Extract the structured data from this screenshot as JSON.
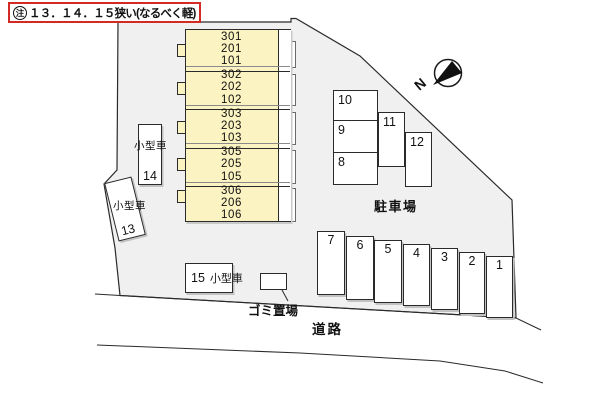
{
  "note": {
    "mark": "注",
    "text": "１３．１４．１５狭い(なるべく軽)"
  },
  "compass": {
    "north_label": "N"
  },
  "building": {
    "sections": [
      {
        "rooms": [
          "301",
          "201",
          "101"
        ]
      },
      {
        "rooms": [
          "302",
          "202",
          "102"
        ]
      },
      {
        "rooms": [
          "303",
          "203",
          "103"
        ]
      },
      {
        "rooms": [
          "305",
          "205",
          "105"
        ]
      },
      {
        "rooms": [
          "306",
          "206",
          "106"
        ]
      }
    ]
  },
  "parking": {
    "area_label": "駐車場",
    "small_car_label": "小型車",
    "spaces": [
      "1",
      "2",
      "3",
      "4",
      "5",
      "6",
      "7",
      "8",
      "9",
      "10",
      "11",
      "12",
      "13",
      "14",
      "15"
    ]
  },
  "road_label": "道路",
  "garbage_label": "ゴミ置場",
  "colors": {
    "site_fill": "#f0f0f0",
    "building_fill": "#fbf3c1",
    "note_border": "#d22b25",
    "line": "#2a2a2a"
  }
}
